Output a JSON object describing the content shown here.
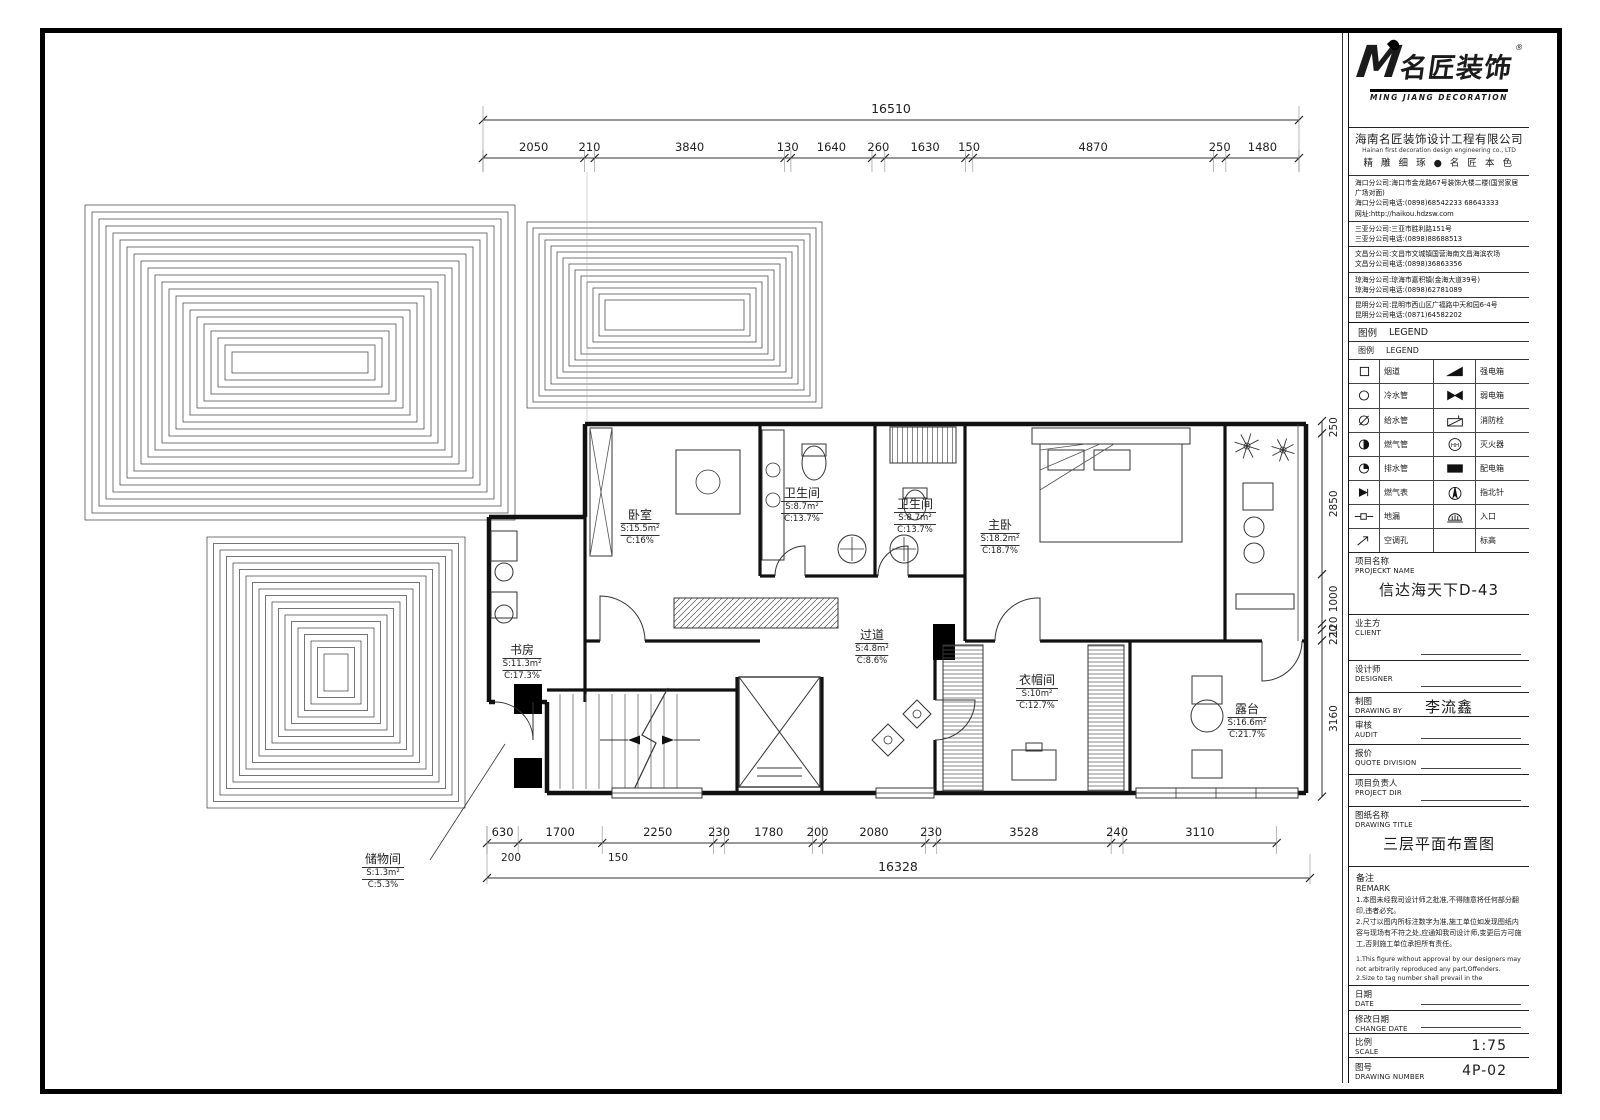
{
  "logo": {
    "m": "M",
    "brand": "名匠装饰",
    "reg": "®",
    "subtitle": "MING JIANG DECORATION"
  },
  "company": {
    "name": "海南名匠装饰设计工程有限公司",
    "name_en": "Hainan first decoration design engineering co., LTD",
    "slogan": "精 雕 细 琢 ● 名 匠 本 色"
  },
  "branches": [
    {
      "lines": [
        "海口分公司:海口市金龙路67号装饰大楼二楼(国贸家居广场对面)",
        "海口分公司电话:(0898)68542233 68643333",
        "网址:http://haikou.hdzsw.com"
      ]
    },
    {
      "lines": [
        "三亚分公司:三亚市胜利路151号",
        "三亚分公司电话:(0898)88688513"
      ]
    },
    {
      "lines": [
        "文昌分公司:文昌市文城镇国营海南文昌海滨农场",
        "文昌分公司电话:(0898)36863356"
      ]
    },
    {
      "lines": [
        "琼海分公司:琼海市嘉积镇(金海大道39号)",
        "琼海分公司电话:(0898)62781089"
      ]
    },
    {
      "lines": [
        "昆明分公司:昆明市西山区广福路中天和园6-4号",
        "昆明分公司电话:(0871)64582202"
      ]
    }
  ],
  "legend": {
    "title_cn": "图例",
    "title_en": "LEGEND",
    "sub_cn": "图例",
    "sub_en": "LEGEND",
    "rows": [
      {
        "l": "烟道",
        "li": "flue",
        "r": "强电箱",
        "ri": "power-box"
      },
      {
        "l": "冷水管",
        "li": "cold-water",
        "r": "弱电箱",
        "ri": "weak-box"
      },
      {
        "l": "给水管",
        "li": "supply-water",
        "r": "消防栓",
        "ri": "hydrant"
      },
      {
        "l": "燃气管",
        "li": "gas-pipe",
        "r": "灭火器",
        "ri": "extinguisher"
      },
      {
        "l": "排水管",
        "li": "drain-pipe",
        "r": "配电箱",
        "ri": "dist-box"
      },
      {
        "l": "燃气表",
        "li": "gas-meter",
        "r": "指北针",
        "ri": "north-arrow"
      },
      {
        "l": "地漏",
        "li": "floor-drain",
        "r": "入口",
        "ri": "entrance"
      },
      {
        "l": "空调孔",
        "li": "ac-hole",
        "r": "标高",
        "ri": "elevation"
      }
    ]
  },
  "fields": {
    "project": {
      "cn": "项目名称",
      "en": "PROJECKT NAME",
      "value": "信达海天下D-43"
    },
    "client": {
      "cn": "业主方",
      "en": "CLIENT",
      "value": ""
    },
    "designer": {
      "cn": "设计师",
      "en": "DESIGNER",
      "value": ""
    },
    "drawing_by": {
      "cn": "制图",
      "en": "DRAWING BY",
      "value": "李流鑫"
    },
    "audit": {
      "cn": "审核",
      "en": "AUDIT",
      "value": ""
    },
    "quote": {
      "cn": "报价",
      "en": "QUOTE DIVISION",
      "value": ""
    },
    "project_dir": {
      "cn": "项目负责人",
      "en": "PROJECT DIR",
      "value": ""
    },
    "drawing_title": {
      "cn": "图纸名称",
      "en": "DRAWING TITLE",
      "value": "三层平面布置图"
    },
    "date": {
      "cn": "日期",
      "en": "DATE",
      "value": ""
    },
    "change_date": {
      "cn": "修改日期",
      "en": "CHANGE DATE",
      "value": ""
    },
    "scale": {
      "cn": "比例",
      "en": "SCALE",
      "value": "1:75"
    },
    "number": {
      "cn": "图号",
      "en": "DRAWING NUMBER",
      "value": "4P-02"
    }
  },
  "remark": {
    "cn": "备注",
    "en": "REMARK",
    "notes_cn": [
      "1.本图未经我司设计师之批准,不得随意将任何部分翻印,违者必究。",
      "2.尺寸以图内所标注数字为准,施工单位如发现图纸内容与现场有不符之处,应通知我司设计师,变更后方可施工,否则施工单位承担所有责任。"
    ],
    "notes_en": [
      "1.This figure without approval by our designers may not arbitrarily reproduced any part,Offenders.",
      "2.Size to tag number shall prevail in the construction units such as find drawings Capacity and the scene there are discrepancies, should inform our designer, then can change."
    ]
  },
  "rooms": [
    {
      "name": "卧室",
      "s": "S:15.5m²",
      "c": "C:16%"
    },
    {
      "name": "卫生间",
      "s": "S:8.7m²",
      "c": "C:13.7%"
    },
    {
      "name": "卫生间",
      "s": "S:8.7m²",
      "c": "C:13.7%"
    },
    {
      "name": "主卧",
      "s": "S:18.2m²",
      "c": "C:18.7%"
    },
    {
      "name": "书房",
      "s": "S:11.3m²",
      "c": "C:17.3%"
    },
    {
      "name": "过道",
      "s": "S:4.8m²",
      "c": "C:8.6%"
    },
    {
      "name": "衣帽间",
      "s": "S:10m²",
      "c": "C:12.7%"
    },
    {
      "name": "露台",
      "s": "S:16.6m²",
      "c": "C:21.7%"
    },
    {
      "name": "储物间",
      "s": "S:1.3m²",
      "c": "C:5.3%"
    }
  ],
  "dimensions": {
    "top_total": "16510",
    "top_segments": [
      2050,
      210,
      3840,
      130,
      1640,
      260,
      1630,
      150,
      4870,
      250,
      1480
    ],
    "bottom_segments": [
      630,
      1700,
      2250,
      230,
      1780,
      200,
      2080,
      230,
      3528,
      240,
      3110
    ],
    "bottom_sub": [
      "200",
      "150"
    ],
    "bottom_total": "16328",
    "right_segments": [
      250,
      2850,
      1000,
      120,
      220,
      3160
    ]
  }
}
